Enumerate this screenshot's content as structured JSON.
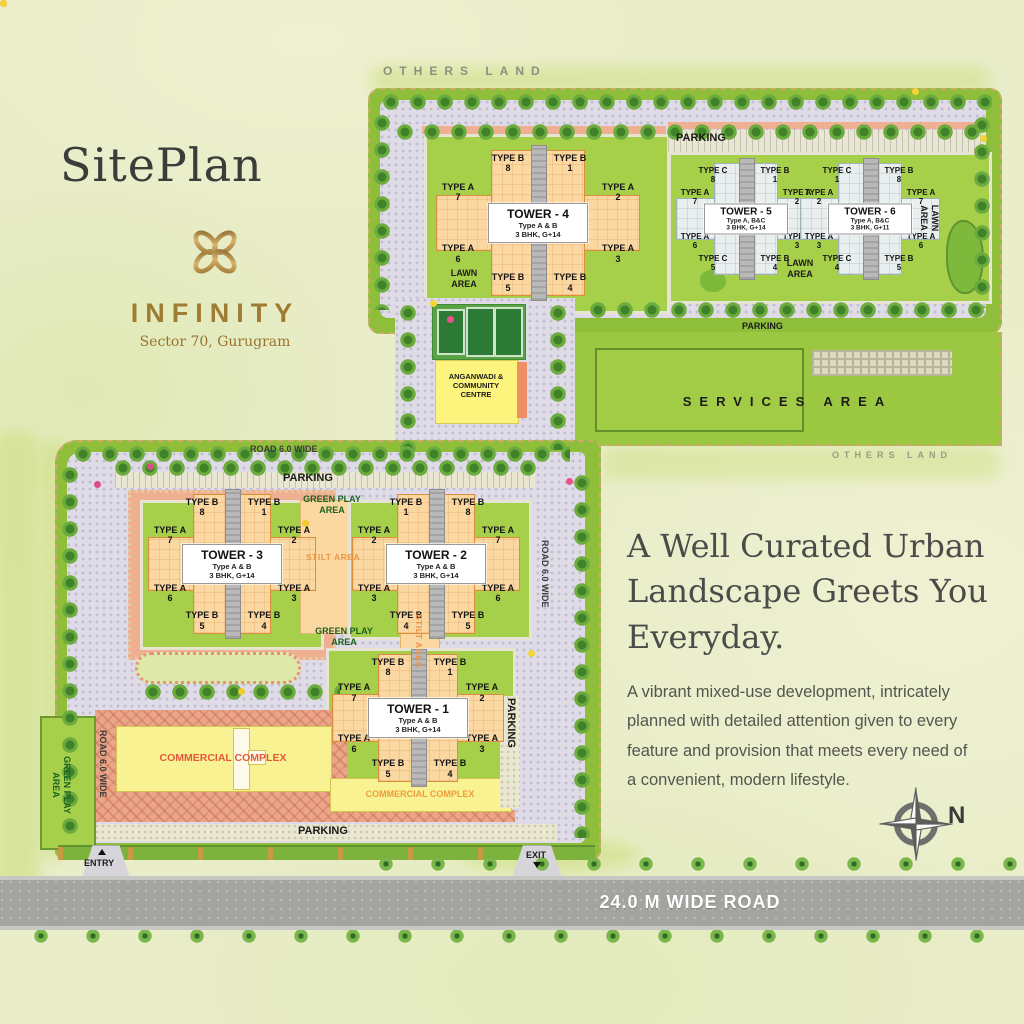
{
  "header": {
    "title": "SitePlan",
    "brand": "INFINITY",
    "brand_location": "Sector 70, Gurugram"
  },
  "promo": {
    "headline_lines": [
      "A Well Curated Urban",
      "Landscape Greets You",
      "Everyday."
    ],
    "body": "A vibrant mixed-use development, intricately planned with detailed attention given to every feature and provision that meets every need of a convenient, modern lifestyle.",
    "compass": "N"
  },
  "roads": {
    "main_road": "24.0 M WIDE ROAD",
    "road_60_top": "ROAD 6.0 WIDE",
    "road_60_left": "ROAD 6.0 WIDE",
    "road_60_right": "ROAD 6.0 WIDE",
    "entry": "ENTRY",
    "exit": "EXIT"
  },
  "areas": {
    "others_land_top": "OTHERS LAND",
    "others_land_right": "OTHERS LAND",
    "parking_top": "PARKING",
    "parking_services": "PARKING",
    "parking_lower": "PARKING",
    "parking_lower_right": "PARKING",
    "parking_lower_bottom": "PARKING",
    "services": "SERVICES AREA",
    "lawn_t4": "LAWN AREA",
    "lawn_t56": "LAWN AREA",
    "lawn_right": "LAWN AREA",
    "anganwadi": "ANGANWADI & COMMUNITY CENTRE",
    "green_play_top": "GREEN PLAY AREA",
    "green_play_mid": "GREEN PLAY AREA",
    "green_play_left": "GREEN PLAY AREA",
    "stilt_h": "STILT AREA",
    "stilt_v": "STILT AREA",
    "commercial_main": "COMMERCIAL COMPLEX",
    "commercial_t1": "COMMERCIAL COMPLEX"
  },
  "towers": [
    {
      "name": "TOWER - 4",
      "sub1": "Type A & B",
      "sub2": "3 BHK, G+14",
      "units": [
        {
          "t": "TYPE B",
          "n": "8",
          "pos": "bt-l"
        },
        {
          "t": "TYPE B",
          "n": "1",
          "pos": "bt-r"
        },
        {
          "t": "TYPE A",
          "n": "7",
          "pos": "al-t"
        },
        {
          "t": "TYPE A",
          "n": "2",
          "pos": "ar-t"
        },
        {
          "t": "TYPE A",
          "n": "6",
          "pos": "al-b"
        },
        {
          "t": "TYPE A",
          "n": "3",
          "pos": "ar-b"
        },
        {
          "t": "TYPE B",
          "n": "5",
          "pos": "bb-l"
        },
        {
          "t": "TYPE B",
          "n": "4",
          "pos": "bb-r"
        }
      ]
    },
    {
      "name": "TOWER - 5",
      "sub1": "Type A, B&C",
      "sub2": "3 BHK, G+14",
      "units": [
        {
          "t": "TYPE C",
          "n": "8",
          "pos": "bt-l"
        },
        {
          "t": "TYPE B",
          "n": "1",
          "pos": "bt-r"
        },
        {
          "t": "TYPE A",
          "n": "7",
          "pos": "al-t"
        },
        {
          "t": "TYPE A",
          "n": "2",
          "pos": "ar-t"
        },
        {
          "t": "TYPE A",
          "n": "6",
          "pos": "al-b"
        },
        {
          "t": "TYPE A",
          "n": "3",
          "pos": "ar-b"
        },
        {
          "t": "TYPE C",
          "n": "5",
          "pos": "bb-l"
        },
        {
          "t": "TYPE B",
          "n": "4",
          "pos": "bb-r"
        }
      ]
    },
    {
      "name": "TOWER - 6",
      "sub1": "Type A, B&C",
      "sub2": "3 BHK, G+11",
      "units": [
        {
          "t": "TYPE C",
          "n": "1",
          "pos": "bt-l"
        },
        {
          "t": "TYPE B",
          "n": "8",
          "pos": "bt-r"
        },
        {
          "t": "TYPE A",
          "n": "2",
          "pos": "al-t"
        },
        {
          "t": "TYPE A",
          "n": "7",
          "pos": "ar-t"
        },
        {
          "t": "TYPE A",
          "n": "3",
          "pos": "al-b"
        },
        {
          "t": "TYPE A",
          "n": "6",
          "pos": "ar-b"
        },
        {
          "t": "TYPE C",
          "n": "4",
          "pos": "bb-l"
        },
        {
          "t": "TYPE B",
          "n": "5",
          "pos": "bb-r"
        }
      ]
    },
    {
      "name": "TOWER - 3",
      "sub1": "Type A & B",
      "sub2": "3 BHK, G+14",
      "units": [
        {
          "t": "TYPE B",
          "n": "8",
          "pos": "bt-l"
        },
        {
          "t": "TYPE B",
          "n": "1",
          "pos": "bt-r"
        },
        {
          "t": "TYPE A",
          "n": "7",
          "pos": "al-t"
        },
        {
          "t": "TYPE A",
          "n": "2",
          "pos": "ar-t"
        },
        {
          "t": "TYPE A",
          "n": "6",
          "pos": "al-b"
        },
        {
          "t": "TYPE A",
          "n": "3",
          "pos": "ar-b"
        },
        {
          "t": "TYPE B",
          "n": "5",
          "pos": "bb-l"
        },
        {
          "t": "TYPE B",
          "n": "4",
          "pos": "bb-r"
        }
      ]
    },
    {
      "name": "TOWER - 2",
      "sub1": "Type A & B",
      "sub2": "3 BHK, G+14",
      "units": [
        {
          "t": "TYPE B",
          "n": "1",
          "pos": "bt-l"
        },
        {
          "t": "TYPE B",
          "n": "8",
          "pos": "bt-r"
        },
        {
          "t": "TYPE A",
          "n": "2",
          "pos": "al-t"
        },
        {
          "t": "TYPE A",
          "n": "7",
          "pos": "ar-t"
        },
        {
          "t": "TYPE A",
          "n": "3",
          "pos": "al-b"
        },
        {
          "t": "TYPE A",
          "n": "6",
          "pos": "ar-b"
        },
        {
          "t": "TYPE B",
          "n": "4",
          "pos": "bb-l"
        },
        {
          "t": "TYPE B",
          "n": "5",
          "pos": "bb-r"
        }
      ]
    },
    {
      "name": "TOWER - 1",
      "sub1": "Type A & B",
      "sub2": "3 BHK, G+14",
      "units": [
        {
          "t": "TYPE B",
          "n": "8",
          "pos": "bt-l"
        },
        {
          "t": "TYPE B",
          "n": "1",
          "pos": "bt-r"
        },
        {
          "t": "TYPE A",
          "n": "7",
          "pos": "al-t"
        },
        {
          "t": "TYPE A",
          "n": "2",
          "pos": "ar-t"
        },
        {
          "t": "TYPE A",
          "n": "6",
          "pos": "al-b"
        },
        {
          "t": "TYPE A",
          "n": "3",
          "pos": "ar-b"
        },
        {
          "t": "TYPE B",
          "n": "5",
          "pos": "bb-l"
        },
        {
          "t": "TYPE B",
          "n": "4",
          "pos": "bb-r"
        }
      ]
    }
  ],
  "colors": {
    "brand_gold": "#a07c33",
    "site_green": "#8fbf3a",
    "tower_peach": "#fbd7a2",
    "accent_orange": "#ec9545",
    "road_gray": "#a3a39f"
  }
}
